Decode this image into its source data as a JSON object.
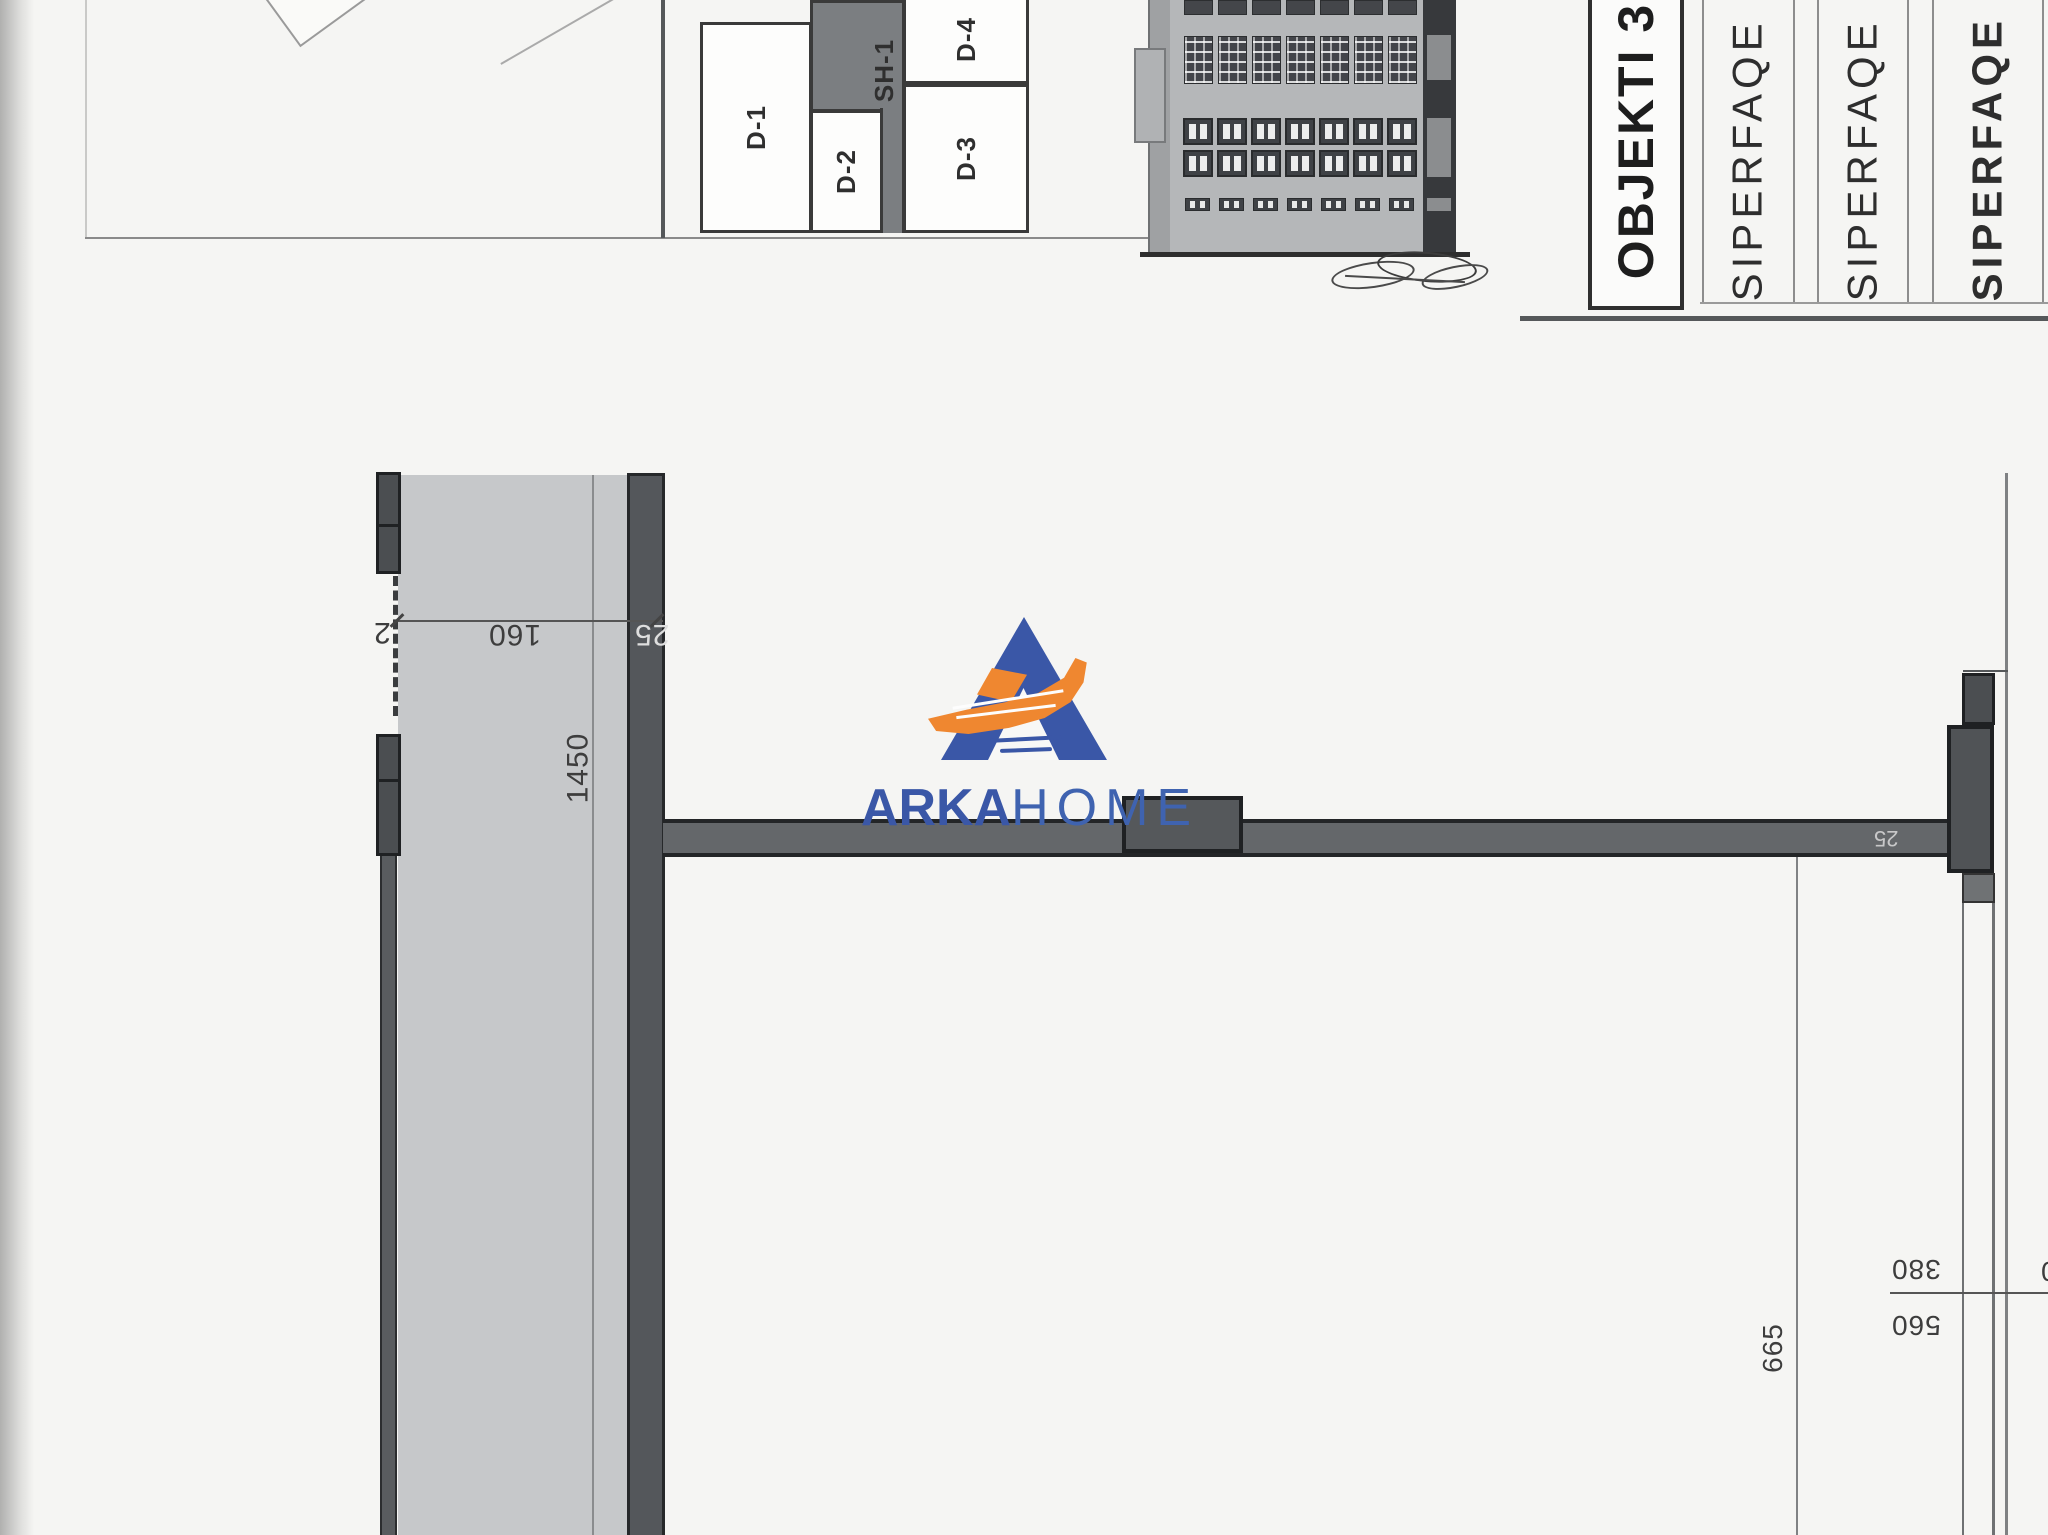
{
  "drawing": {
    "key_plan": {
      "rooms": [
        {
          "label": "D-1"
        },
        {
          "label": "D-2"
        },
        {
          "label": "SH-1"
        },
        {
          "label": "D-3"
        },
        {
          "label": "D-4"
        }
      ]
    },
    "title_block": {
      "object_title": "OBJEKTI 3",
      "columns": [
        {
          "label": "SIPERFAQE E"
        },
        {
          "label": "SIPERFAQE E"
        },
        {
          "label": "SIPERFAQE T"
        }
      ]
    },
    "elevation": {
      "window_columns": 7
    },
    "dimensions": {
      "left_tick": "2",
      "left_opening": "160",
      "left_wall": "25",
      "left_vertical": "1450",
      "right_wall": "25",
      "right_vertical": "665",
      "right_upper": "380",
      "right_lower": "560",
      "right_edge_partial": "0"
    },
    "logo": {
      "word_bold": "ARKA",
      "word_light": "HOME"
    }
  },
  "colors": {
    "logo_blue": "#3a57a7",
    "logo_orange": "#ef8730",
    "wall_dark": "#54575b",
    "band_gray": "#c6c8ca"
  }
}
